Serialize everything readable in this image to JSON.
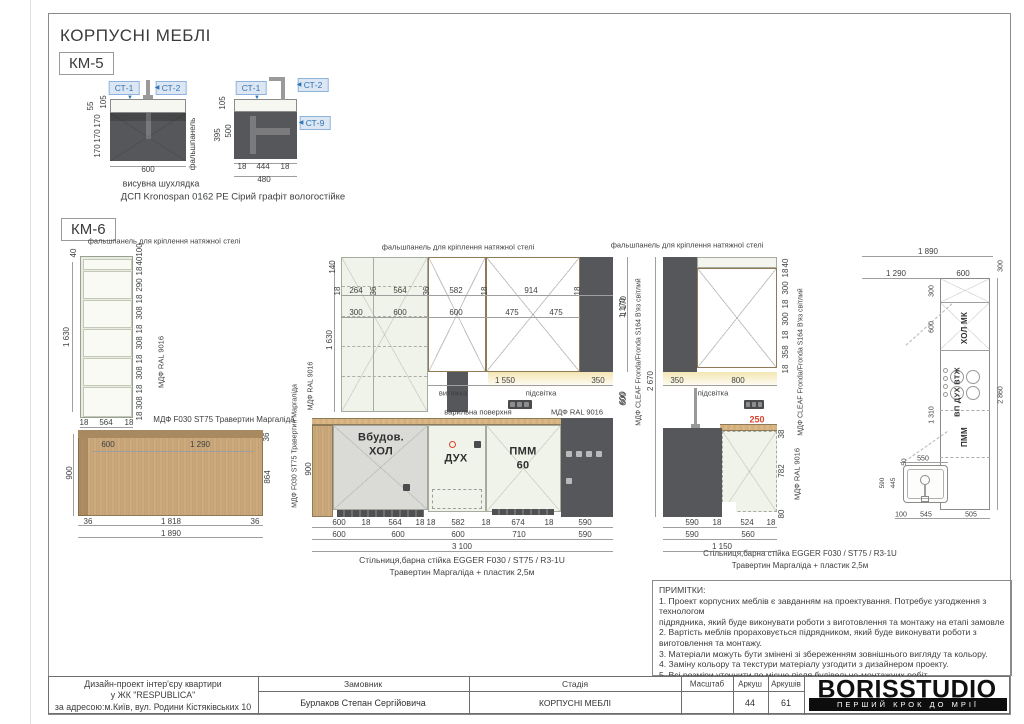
{
  "sheet": {
    "title": "КОРПУСНІ МЕБЛІ",
    "km5_label": "КМ-5",
    "km6_label": "КМ-6"
  },
  "km5": {
    "refs": [
      {
        "t": "СТ-1",
        "x": 124,
        "y": 88
      },
      {
        "t": "СТ-2",
        "x": 171,
        "y": 88
      },
      {
        "t": "СТ-1",
        "x": 251,
        "y": 88
      },
      {
        "t": "СТ-2",
        "x": 313,
        "y": 85
      },
      {
        "t": "СТ-9",
        "x": 315,
        "y": 123
      }
    ],
    "ann": [
      {
        "t": "105",
        "x": 104,
        "y": 102,
        "r": 1
      },
      {
        "t": "55",
        "x": 91,
        "y": 106,
        "r": 1
      },
      {
        "t": "170",
        "x": 98,
        "y": 121,
        "r": 1
      },
      {
        "t": "170",
        "x": 98,
        "y": 136,
        "r": 1
      },
      {
        "t": "170",
        "x": 98,
        "y": 151,
        "r": 1
      },
      {
        "t": "600",
        "x": 148,
        "y": 170
      },
      {
        "t": "фальшпанель",
        "x": 193,
        "y": 144,
        "r": 1,
        "s": 8
      },
      {
        "t": "висувна шухлядка",
        "x": 161,
        "y": 184,
        "s": 9
      },
      {
        "t": "105",
        "x": 223,
        "y": 103,
        "r": 1
      },
      {
        "t": "500",
        "x": 229,
        "y": 131,
        "r": 1
      },
      {
        "t": "395",
        "x": 218,
        "y": 135,
        "r": 1
      },
      {
        "t": "18",
        "x": 242,
        "y": 167
      },
      {
        "t": "444",
        "x": 263,
        "y": 167
      },
      {
        "t": "18",
        "x": 285,
        "y": 167
      },
      {
        "t": "480",
        "x": 264,
        "y": 180
      },
      {
        "t": "ДСП Kronospan 0162 PE Сірий графіт вологостійке",
        "x": 233,
        "y": 197,
        "s": 9.5
      },
      {
        "t": "▼",
        "x": 130,
        "y": 98,
        "c": "blue",
        "s": 6
      },
      {
        "t": "◀",
        "x": 157,
        "y": 88,
        "c": "blue",
        "s": 6
      },
      {
        "t": "▼",
        "x": 257,
        "y": 98,
        "c": "blue",
        "s": 6
      },
      {
        "t": "◀",
        "x": 299,
        "y": 85,
        "c": "blue",
        "s": 6
      },
      {
        "t": "◀",
        "x": 301,
        "y": 123,
        "c": "blue",
        "s": 6
      }
    ]
  },
  "km6": {
    "ann": [
      {
        "t": "фальшпанель для кріплення натяжної стелі",
        "x": 164,
        "y": 241,
        "s": 7.5
      },
      {
        "t": "40",
        "x": 74,
        "y": 253,
        "r": 1
      },
      {
        "t": "1 630",
        "x": 67,
        "y": 337,
        "r": 1
      },
      {
        "t": "100",
        "x": 140,
        "y": 250,
        "r": 1
      },
      {
        "t": "40",
        "x": 140,
        "y": 261,
        "r": 1
      },
      {
        "t": "18",
        "x": 140,
        "y": 271,
        "r": 1
      },
      {
        "t": "290",
        "x": 140,
        "y": 285,
        "r": 1
      },
      {
        "t": "18",
        "x": 140,
        "y": 299,
        "r": 1
      },
      {
        "t": "308",
        "x": 140,
        "y": 313,
        "r": 1
      },
      {
        "t": "18",
        "x": 140,
        "y": 329,
        "r": 1
      },
      {
        "t": "308",
        "x": 140,
        "y": 343,
        "r": 1
      },
      {
        "t": "18",
        "x": 140,
        "y": 359,
        "r": 1
      },
      {
        "t": "308",
        "x": 140,
        "y": 373,
        "r": 1
      },
      {
        "t": "18",
        "x": 140,
        "y": 389,
        "r": 1
      },
      {
        "t": "308",
        "x": 140,
        "y": 403,
        "r": 1
      },
      {
        "t": "18",
        "x": 140,
        "y": 416,
        "r": 1
      },
      {
        "t": "18",
        "x": 84,
        "y": 423
      },
      {
        "t": "564",
        "x": 106,
        "y": 423
      },
      {
        "t": "18",
        "x": 129,
        "y": 423
      },
      {
        "t": "МДФ RAL 9016",
        "x": 161,
        "y": 362,
        "r": 1,
        "s": 7.5
      },
      {
        "t": "МДФ F030 ST75 Травертин Маргаліда",
        "x": 224,
        "y": 420,
        "s": 8
      },
      {
        "t": "600",
        "x": 108,
        "y": 445
      },
      {
        "t": "1 290",
        "x": 200,
        "y": 445
      },
      {
        "t": "36",
        "x": 267,
        "y": 437,
        "r": 1
      },
      {
        "t": "900",
        "x": 70,
        "y": 473,
        "r": 1
      },
      {
        "t": "864",
        "x": 268,
        "y": 477,
        "r": 1
      },
      {
        "t": "36",
        "x": 88,
        "y": 522
      },
      {
        "t": "1 818",
        "x": 171,
        "y": 522
      },
      {
        "t": "36",
        "x": 255,
        "y": 522
      },
      {
        "t": "1 890",
        "x": 171,
        "y": 534
      },
      {
        "t": "фальшпанель для кріплення натяжної стелі",
        "x": 458,
        "y": 247,
        "s": 7.5
      },
      {
        "t": "140",
        "x": 333,
        "y": 267,
        "r": 1
      },
      {
        "t": "1 630",
        "x": 330,
        "y": 340,
        "r": 1
      },
      {
        "t": "18",
        "x": 338,
        "y": 291,
        "r": 1
      },
      {
        "t": "264",
        "x": 356,
        "y": 291
      },
      {
        "t": "36",
        "x": 374,
        "y": 291,
        "r": 1
      },
      {
        "t": "564",
        "x": 400,
        "y": 291
      },
      {
        "t": "36",
        "x": 427,
        "y": 291,
        "r": 1
      },
      {
        "t": "582",
        "x": 456,
        "y": 291
      },
      {
        "t": "18",
        "x": 485,
        "y": 291,
        "r": 1
      },
      {
        "t": "914",
        "x": 531,
        "y": 291
      },
      {
        "t": "18",
        "x": 578,
        "y": 291,
        "r": 1
      },
      {
        "t": "300",
        "x": 356,
        "y": 313
      },
      {
        "t": "600",
        "x": 400,
        "y": 313
      },
      {
        "t": "600",
        "x": 456,
        "y": 313
      },
      {
        "t": "475",
        "x": 512,
        "y": 313
      },
      {
        "t": "475",
        "x": 556,
        "y": 313
      },
      {
        "t": "1 170",
        "x": 623,
        "y": 308,
        "r": 1
      },
      {
        "t": "600",
        "x": 623,
        "y": 398,
        "r": 1
      },
      {
        "t": "1 550",
        "x": 505,
        "y": 381
      },
      {
        "t": "350",
        "x": 598,
        "y": 381
      },
      {
        "t": "витяжка",
        "x": 453,
        "y": 393,
        "s": 7.5
      },
      {
        "t": "підсвітка",
        "x": 541,
        "y": 393,
        "s": 7.5
      },
      {
        "t": "варильна поверхня",
        "x": 478,
        "y": 412,
        "s": 7.5
      },
      {
        "t": "МДФ RAL 9016",
        "x": 577,
        "y": 412,
        "s": 7.5
      },
      {
        "t": "Вбудов.",
        "x": 381,
        "y": 438,
        "b": 1
      },
      {
        "t": "ХОЛ",
        "x": 381,
        "y": 452,
        "b": 1
      },
      {
        "t": "ДУХ",
        "x": 456,
        "y": 459,
        "b": 1
      },
      {
        "t": "ПММ",
        "x": 523,
        "y": 452,
        "b": 1
      },
      {
        "t": "60",
        "x": 523,
        "y": 466,
        "b": 1
      },
      {
        "t": "900",
        "x": 309,
        "y": 469,
        "r": 1
      },
      {
        "t": "МДФ F030 ST75 Травертин Маргаліда",
        "x": 295,
        "y": 446,
        "r": 1,
        "s": 7
      },
      {
        "t": "МДФ RAL 9016",
        "x": 311,
        "y": 386,
        "r": 1,
        "s": 7
      },
      {
        "t": "600",
        "x": 339,
        "y": 523
      },
      {
        "t": "18",
        "x": 366,
        "y": 523
      },
      {
        "t": "564",
        "x": 395,
        "y": 523
      },
      {
        "t": "18",
        "x": 420,
        "y": 523
      },
      {
        "t": "18",
        "x": 431,
        "y": 523
      },
      {
        "t": "582",
        "x": 458,
        "y": 523
      },
      {
        "t": "18",
        "x": 486,
        "y": 523
      },
      {
        "t": "674",
        "x": 518,
        "y": 523
      },
      {
        "t": "18",
        "x": 549,
        "y": 523
      },
      {
        "t": "590",
        "x": 585,
        "y": 523
      },
      {
        "t": "600",
        "x": 339,
        "y": 535
      },
      {
        "t": "600",
        "x": 398,
        "y": 535
      },
      {
        "t": "600",
        "x": 458,
        "y": 535
      },
      {
        "t": "710",
        "x": 519,
        "y": 535
      },
      {
        "t": "590",
        "x": 585,
        "y": 535
      },
      {
        "t": "3 100",
        "x": 462,
        "y": 547
      },
      {
        "t": "Стільниця,барна стійка EGGER F030 / ST75 / R3-1U",
        "x": 462,
        "y": 560,
        "s": 8.5
      },
      {
        "t": "Травертин Маргаліда + пластик 2,5м",
        "x": 462,
        "y": 572,
        "s": 8.5
      },
      {
        "t": "фальшпанель для кріплення натяжної стелі",
        "x": 687,
        "y": 245,
        "s": 7.5
      },
      {
        "t": "1 170",
        "x": 624,
        "y": 306,
        "r": 1
      },
      {
        "t": "600",
        "x": 624,
        "y": 399,
        "r": 1
      },
      {
        "t": "2 670",
        "x": 651,
        "y": 381,
        "r": 1
      },
      {
        "t": "МДФ CLEAF Fronda/Fronda S164 В'яз світлий",
        "x": 639,
        "y": 352,
        "r": 1,
        "s": 7
      },
      {
        "t": "350",
        "x": 677,
        "y": 381
      },
      {
        "t": "800",
        "x": 738,
        "y": 381
      },
      {
        "t": "підсвітка",
        "x": 713,
        "y": 393,
        "s": 7.5
      },
      {
        "t": "40",
        "x": 786,
        "y": 263,
        "r": 1
      },
      {
        "t": "18",
        "x": 786,
        "y": 273,
        "r": 1
      },
      {
        "t": "300",
        "x": 786,
        "y": 288,
        "r": 1
      },
      {
        "t": "18",
        "x": 786,
        "y": 304,
        "r": 1
      },
      {
        "t": "300",
        "x": 786,
        "y": 319,
        "r": 1
      },
      {
        "t": "18",
        "x": 786,
        "y": 335,
        "r": 1
      },
      {
        "t": "358",
        "x": 786,
        "y": 352,
        "r": 1
      },
      {
        "t": "18",
        "x": 786,
        "y": 369,
        "r": 1
      },
      {
        "t": "МДФ CLEAF Fronda/Fronda S164 В'яз світлий",
        "x": 801,
        "y": 362,
        "r": 1,
        "s": 7
      },
      {
        "t": "250",
        "x": 757,
        "y": 420,
        "c": "red",
        "s": 9
      },
      {
        "t": "38",
        "x": 782,
        "y": 434,
        "r": 1
      },
      {
        "t": "782",
        "x": 782,
        "y": 471,
        "r": 1
      },
      {
        "t": "80",
        "x": 782,
        "y": 514,
        "r": 1
      },
      {
        "t": "МДФ RAL 9016",
        "x": 797,
        "y": 474,
        "r": 1,
        "s": 7.5
      },
      {
        "t": "590",
        "x": 692,
        "y": 523
      },
      {
        "t": "18",
        "x": 717,
        "y": 523
      },
      {
        "t": "524",
        "x": 747,
        "y": 523
      },
      {
        "t": "18",
        "x": 771,
        "y": 523
      },
      {
        "t": "590",
        "x": 692,
        "y": 535
      },
      {
        "t": "560",
        "x": 748,
        "y": 535
      },
      {
        "t": "1 150",
        "x": 722,
        "y": 547
      },
      {
        "t": "Стільниця,барна стійка EGGER F030 / ST75 / R3-1U",
        "x": 800,
        "y": 554,
        "s": 8
      },
      {
        "t": "Травертин Маргаліда + пластик 2,5м",
        "x": 800,
        "y": 566,
        "s": 8
      },
      {
        "t": "1 890",
        "x": 928,
        "y": 252
      },
      {
        "t": "1 290",
        "x": 896,
        "y": 274
      },
      {
        "t": "600",
        "x": 963,
        "y": 274
      },
      {
        "t": "300",
        "x": 1001,
        "y": 266,
        "r": 1,
        "s": 7
      },
      {
        "t": "2 860",
        "x": 1001,
        "y": 395,
        "r": 1,
        "s": 7
      },
      {
        "t": "300",
        "x": 932,
        "y": 291,
        "r": 1,
        "s": 7
      },
      {
        "t": "600",
        "x": 932,
        "y": 327,
        "r": 1,
        "s": 7
      },
      {
        "t": "1 310",
        "x": 932,
        "y": 415,
        "r": 1,
        "s": 7
      },
      {
        "t": "ХОЛ МК",
        "x": 965,
        "y": 328,
        "r": 1,
        "b": 1,
        "s": 8
      },
      {
        "t": "ВП ДУХ ВТЖ",
        "x": 957,
        "y": 392,
        "r": 1,
        "b": 1,
        "s": 7.5
      },
      {
        "t": "ПММ",
        "x": 965,
        "y": 437,
        "r": 1,
        "b": 1,
        "s": 8
      },
      {
        "t": "550",
        "x": 923,
        "y": 459,
        "s": 7
      },
      {
        "t": "50",
        "x": 905,
        "y": 462,
        "r": 1,
        "s": 6.5
      },
      {
        "t": "445",
        "x": 894,
        "y": 483,
        "r": 1,
        "s": 6.5
      },
      {
        "t": "590",
        "x": 883,
        "y": 483,
        "r": 1,
        "s": 6.5
      },
      {
        "t": "100",
        "x": 901,
        "y": 515,
        "s": 7
      },
      {
        "t": "545",
        "x": 926,
        "y": 515,
        "s": 7
      },
      {
        "t": "505",
        "x": 971,
        "y": 515,
        "s": 7
      }
    ]
  },
  "notes": {
    "title": "ПРИМІТКИ:",
    "lines": [
      "1. Проект корпусних меблів є завданням на проектування. Потребує узгодження з",
      "технологом",
      "підрядника, який буде виконувати роботи з виготовлення та монтажу на етапі замовлення.",
      "2. Вартість меблів прораховується підрядником, який буде виконувати роботи з",
      "виготовлення та монтажу.",
      "3. Матеріали можуть бути змінені зі збереженням зовнішнього вигляду та кольору.",
      "4. Заміну кольору та текстури матеріалу узгодити з дизайнером проекту.",
      "5. Всі розміри уточнити по місцю після будівельно-монтажних робіт."
    ]
  },
  "titleblock": {
    "project_lines": [
      "Дизайн-проект інтер'єру квартири",
      "у ЖК \"RESPUBLICA\"",
      "за адресою:м.Київ, вул. Родини Кістяківських 10"
    ],
    "client_label": "Замовник",
    "client_value": "Бурлаков Степан Сергійовича",
    "stage_label": "Стадія",
    "stage_value": "КОРПУСНІ МЕБЛІ",
    "scale_label": "Масштаб",
    "scale_value": "",
    "sheet_label": "Аркуш",
    "sheet_value": "44",
    "sheets_label": "Аркушів",
    "sheets_value": "61",
    "logo": {
      "name": "BORISSTUDIO",
      "tagline": "ПЕРШИЙ КРОК ДО МРІЇ"
    }
  },
  "colors": {
    "wood": "#c9a77a",
    "dark": "#56575a",
    "mint": "#f0f3e9",
    "accent_blue": "#2e74b5",
    "red": "#d9442f"
  }
}
